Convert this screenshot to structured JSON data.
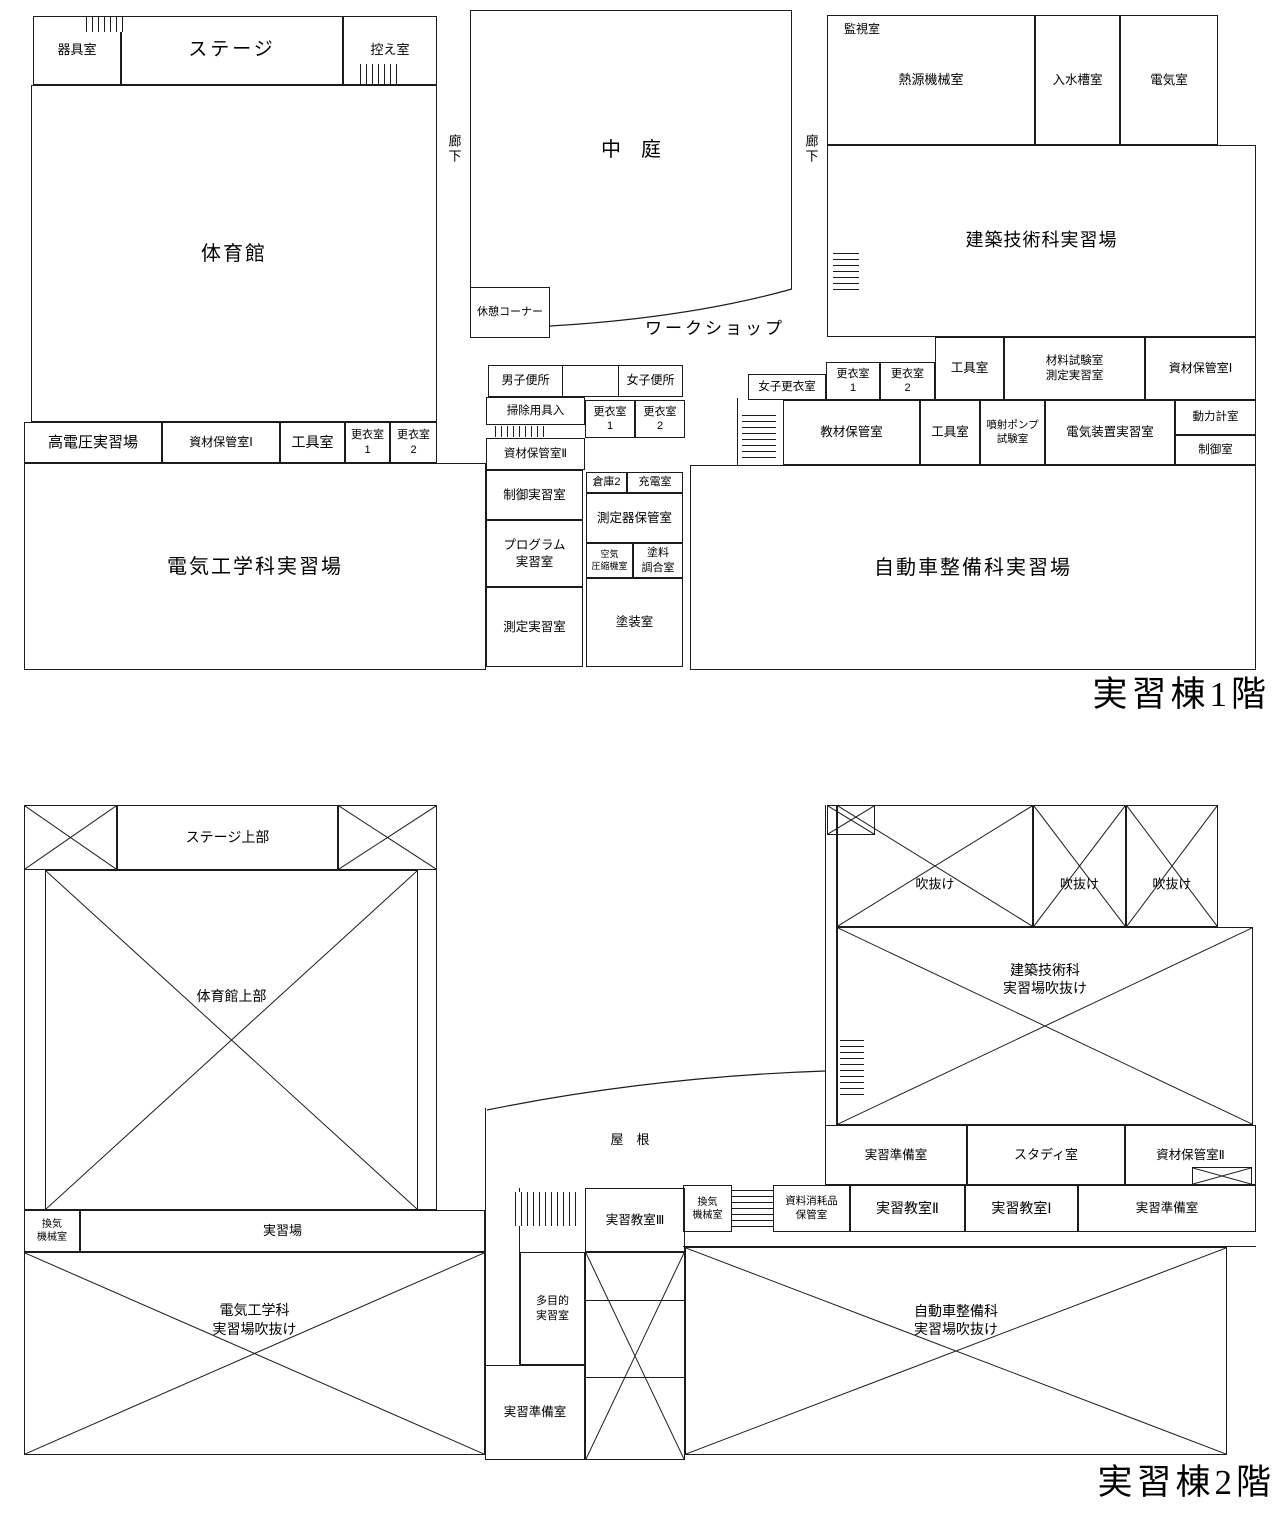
{
  "doc_title": "実習棟平面図",
  "floors": [
    {
      "name": "floor-1",
      "caption": "実習棟1階",
      "rooms": [
        {
          "id": "equipment-room",
          "label": "器具室",
          "x": 33,
          "y": 16,
          "w": 88,
          "h": 69,
          "fs": 13
        },
        {
          "id": "stage",
          "label": "ステージ",
          "x": 121,
          "y": 16,
          "w": 222,
          "h": 69,
          "fs": 19,
          "ls": 3
        },
        {
          "id": "green-room",
          "label": "控え室",
          "x": 343,
          "y": 16,
          "w": 94,
          "h": 69,
          "fs": 13
        },
        {
          "id": "stairs",
          "type": "stairs",
          "dir": "v",
          "x": 86,
          "y": 17,
          "w": 38,
          "h": 15
        },
        {
          "id": "stairs",
          "type": "stairs",
          "dir": "v",
          "x": 360,
          "y": 64,
          "w": 38,
          "h": 20
        },
        {
          "id": "gymnasium",
          "label": "体育館",
          "x": 31,
          "y": 85,
          "w": 406,
          "h": 337,
          "fs": 20,
          "ls": 2
        },
        {
          "id": "high-voltage-training-area",
          "label": "高電圧実習場",
          "x": 24,
          "y": 422,
          "w": 138,
          "h": 41,
          "fs": 15
        },
        {
          "id": "material-storage-room-1",
          "label": "資材保管室Ⅰ",
          "x": 162,
          "y": 422,
          "w": 118,
          "h": 41,
          "fs": 12
        },
        {
          "id": "tool-room",
          "label": "工具室",
          "x": 280,
          "y": 422,
          "w": 65,
          "h": 41,
          "fs": 14
        },
        {
          "id": "changing-room-1",
          "label": "更衣室\n1",
          "x": 345,
          "y": 422,
          "w": 45,
          "h": 41,
          "fs": 11
        },
        {
          "id": "changing-room-2",
          "label": "更衣室\n2",
          "x": 390,
          "y": 422,
          "w": 47,
          "h": 41,
          "fs": 11
        },
        {
          "id": "electrical-engineering-training-area",
          "label": "電気工学科実習場",
          "x": 24,
          "y": 463,
          "w": 462,
          "h": 207,
          "fs": 20,
          "ls": 2
        },
        {
          "id": "courtyard",
          "label": "中　庭",
          "x": 470,
          "y": 10,
          "w": 322,
          "h": 279,
          "fs": 20,
          "b": "ltr"
        },
        {
          "id": "corridor-label-left",
          "type": "label",
          "label": "廊下",
          "x": 442,
          "y": 126,
          "w": 22,
          "h": 46,
          "fs": 13,
          "vertical": true
        },
        {
          "id": "corridor-label-right",
          "type": "label",
          "label": "廊下",
          "x": 799,
          "y": 126,
          "w": 22,
          "h": 46,
          "fs": 13,
          "vertical": true
        },
        {
          "id": "rest-corner",
          "label": "休憩コーナー",
          "x": 470,
          "y": 287,
          "w": 80,
          "h": 51,
          "fs": 11
        },
        {
          "id": "workshop-label",
          "type": "label",
          "label": "ワークショップ",
          "x": 600,
          "y": 314,
          "w": 230,
          "h": 30,
          "fs": 17,
          "ls": 3
        },
        {
          "id": "mens-toilet",
          "label": "男子便所",
          "x": 488,
          "y": 365,
          "w": 75,
          "h": 32,
          "fs": 12
        },
        {
          "id": "toilet-lobby",
          "label": "",
          "x": 563,
          "y": 365,
          "w": 55,
          "h": 32,
          "b": "tb"
        },
        {
          "id": "womens-toilet",
          "label": "女子便所",
          "x": 618,
          "y": 365,
          "w": 65,
          "h": 32,
          "fs": 12
        },
        {
          "id": "cleaning-supplies-storage",
          "label": "掃除用具入",
          "x": 486,
          "y": 397,
          "w": 99,
          "h": 28,
          "fs": 11.5
        },
        {
          "id": "stairs",
          "type": "stairs",
          "dir": "v",
          "x": 495,
          "y": 426,
          "w": 50,
          "h": 11
        },
        {
          "id": "changing-room-1-center",
          "label": "更衣室\n1",
          "x": 585,
          "y": 400,
          "w": 50,
          "h": 38,
          "fs": 11
        },
        {
          "id": "changing-room-2-center",
          "label": "更衣室\n2",
          "x": 635,
          "y": 400,
          "w": 50,
          "h": 38,
          "fs": 11
        },
        {
          "id": "material-storage-room-2",
          "label": "資材保管室Ⅱ",
          "x": 486,
          "y": 438,
          "w": 99,
          "h": 32,
          "fs": 11.5
        },
        {
          "id": "control-training-room",
          "label": "制御実習室",
          "x": 486,
          "y": 470,
          "w": 97,
          "h": 50,
          "fs": 12.5
        },
        {
          "id": "warehouse-2",
          "label": "倉庫2",
          "x": 586,
          "y": 472,
          "w": 41,
          "h": 21,
          "fs": 11
        },
        {
          "id": "charging-room",
          "label": "充電室",
          "x": 627,
          "y": 472,
          "w": 56,
          "h": 21,
          "fs": 11
        },
        {
          "id": "instrument-storage-room",
          "label": "測定器保管室",
          "x": 586,
          "y": 493,
          "w": 97,
          "h": 50,
          "fs": 12.5
        },
        {
          "id": "program-training-room",
          "label": "プログラム\n実習室",
          "x": 486,
          "y": 520,
          "w": 97,
          "h": 67,
          "fs": 12.5
        },
        {
          "id": "air-compressor-room",
          "label": "空気\n圧縮機室",
          "x": 586,
          "y": 543,
          "w": 47,
          "h": 35,
          "fs": 9
        },
        {
          "id": "paint-mixing-room",
          "label": "塗料\n調合室",
          "x": 633,
          "y": 543,
          "w": 50,
          "h": 35,
          "fs": 11
        },
        {
          "id": "measurement-training-room",
          "label": "測定実習室",
          "x": 486,
          "y": 587,
          "w": 97,
          "h": 80,
          "fs": 12.5
        },
        {
          "id": "painting-room",
          "label": "塗装室",
          "x": 586,
          "y": 578,
          "w": 97,
          "h": 89,
          "fs": 12.5
        },
        {
          "id": "heat-source-machinery-room",
          "label": "熱源機械室",
          "x": 827,
          "y": 15,
          "w": 208,
          "h": 130,
          "fs": 13
        },
        {
          "id": "monitoring-room-label",
          "type": "label",
          "label": "監視室",
          "x": 833,
          "y": 20,
          "w": 58,
          "h": 20,
          "fs": 12
        },
        {
          "id": "water-tank-room",
          "label": "入水槽室",
          "x": 1035,
          "y": 15,
          "w": 85,
          "h": 130,
          "fs": 12.5
        },
        {
          "id": "electric-room",
          "label": "電気室",
          "x": 1120,
          "y": 15,
          "w": 98,
          "h": 130,
          "fs": 12.5
        },
        {
          "id": "architecture-training-area",
          "label": "建築技術科実習場",
          "x": 827,
          "y": 145,
          "w": 429,
          "h": 192,
          "fs": 18,
          "ls": 1
        },
        {
          "id": "stairs",
          "type": "stairs",
          "dir": "h",
          "x": 833,
          "y": 253,
          "w": 26,
          "h": 42
        },
        {
          "id": "womens-changing-room",
          "label": "女子更衣室",
          "x": 748,
          "y": 374,
          "w": 78,
          "h": 26,
          "fs": 11.5
        },
        {
          "id": "changing-room-1-right",
          "label": "更衣室\n1",
          "x": 826,
          "y": 362,
          "w": 54,
          "h": 38,
          "fs": 11
        },
        {
          "id": "changing-room-2-right",
          "label": "更衣室\n2",
          "x": 880,
          "y": 362,
          "w": 55,
          "h": 38,
          "fs": 11
        },
        {
          "id": "tool-room-right",
          "label": "工具室",
          "x": 935,
          "y": 337,
          "w": 69,
          "h": 63,
          "fs": 12.5
        },
        {
          "id": "material-test-room",
          "label": "材料試験室\n測定実習室",
          "x": 1004,
          "y": 337,
          "w": 141,
          "h": 63,
          "fs": 11.5
        },
        {
          "id": "material-storage-room-1-right",
          "label": "資材保管室Ⅰ",
          "x": 1145,
          "y": 337,
          "w": 111,
          "h": 63,
          "fs": 12
        },
        {
          "id": "wall",
          "type": "vline",
          "x": 737,
          "y": 398,
          "h": 67
        },
        {
          "id": "teaching-material-storage",
          "label": "教材保管室",
          "x": 783,
          "y": 400,
          "w": 137,
          "h": 65,
          "fs": 12.5
        },
        {
          "id": "tool-room-auto",
          "label": "工具室",
          "x": 920,
          "y": 400,
          "w": 60,
          "h": 65,
          "fs": 12.5
        },
        {
          "id": "injection-pump-test-room",
          "label": "噴射ポンプ\n試験室",
          "x": 980,
          "y": 400,
          "w": 65,
          "h": 65,
          "fs": 10.5
        },
        {
          "id": "electrical-equipment-training-room",
          "label": "電気装置実習室",
          "x": 1045,
          "y": 400,
          "w": 130,
          "h": 65,
          "fs": 12.5
        },
        {
          "id": "dynamometer-room",
          "label": "動力計室",
          "x": 1175,
          "y": 400,
          "w": 81,
          "h": 35,
          "fs": 11.5
        },
        {
          "id": "control-room",
          "label": "制御室",
          "x": 1175,
          "y": 435,
          "w": 81,
          "h": 30,
          "fs": 11.5
        },
        {
          "id": "stairs",
          "type": "stairs",
          "dir": "h",
          "x": 742,
          "y": 415,
          "w": 34,
          "h": 48
        },
        {
          "id": "auto-maintenance-training-area",
          "label": "自動車整備科実習場",
          "x": 690,
          "y": 465,
          "w": 566,
          "h": 205,
          "fs": 20,
          "ls": 2
        },
        {
          "id": "floor1-caption",
          "type": "label",
          "label": "実習棟1階",
          "x": 990,
          "y": 672,
          "w": 280,
          "h": 46,
          "fs": 35,
          "serif": true,
          "align": "right"
        }
      ]
    },
    {
      "name": "floor-2",
      "caption": "実習棟2階",
      "rooms": [
        {
          "id": "void-stage-left",
          "label": "",
          "x": 24,
          "y": 805,
          "w": 93,
          "h": 65,
          "cross": true
        },
        {
          "id": "stage-upper",
          "label": "ステージ上部",
          "x": 117,
          "y": 805,
          "w": 221,
          "h": 65,
          "fs": 14
        },
        {
          "id": "void-stage-right",
          "label": "",
          "x": 338,
          "y": 805,
          "w": 99,
          "h": 65,
          "cross": true
        },
        {
          "id": "gym-outer-wall",
          "label": "",
          "x": 24,
          "y": 870,
          "w": 413,
          "h": 340,
          "b": "lrb"
        },
        {
          "id": "gymnasium-upper",
          "label": "体育館上部",
          "x": 45,
          "y": 870,
          "w": 373,
          "h": 340,
          "cross": true,
          "fs": 14,
          "ly": 0.37
        },
        {
          "id": "ventilation-machinery-room-left",
          "label": "換気\n機械室",
          "x": 24,
          "y": 1210,
          "w": 56,
          "h": 42,
          "fs": 10
        },
        {
          "id": "training-area",
          "label": "実習場",
          "x": 80,
          "y": 1210,
          "w": 405,
          "h": 42,
          "fs": 13
        },
        {
          "id": "electrical-training-void",
          "label": "電気工学科\n実習場吹抜け",
          "x": 24,
          "y": 1252,
          "w": 461,
          "h": 203,
          "cross": true,
          "fs": 14,
          "ly": 0.33
        },
        {
          "id": "void-small-corner",
          "label": "",
          "x": 827,
          "y": 805,
          "w": 48,
          "h": 30,
          "cross": true
        },
        {
          "id": "void-1",
          "label": "吹抜け",
          "x": 837,
          "y": 805,
          "w": 196,
          "h": 122,
          "cross": true,
          "fs": 13,
          "ly": 0.66
        },
        {
          "id": "void-2",
          "label": "吹抜け",
          "x": 1033,
          "y": 805,
          "w": 93,
          "h": 122,
          "cross": true,
          "fs": 13,
          "ly": 0.66
        },
        {
          "id": "void-3",
          "label": "吹抜け",
          "x": 1126,
          "y": 805,
          "w": 92,
          "h": 122,
          "cross": true,
          "fs": 13,
          "ly": 0.66
        },
        {
          "id": "architecture-training-void",
          "label": "建築技術科\n実習場吹抜け",
          "x": 837,
          "y": 927,
          "w": 416,
          "h": 198,
          "cross": true,
          "fs": 14,
          "ly": 0.26
        },
        {
          "id": "corridor-wall",
          "label": "",
          "x": 825,
          "y": 805,
          "w": 12,
          "h": 320,
          "b": "lr"
        },
        {
          "id": "stairs",
          "type": "stairs",
          "dir": "h",
          "x": 840,
          "y": 1040,
          "w": 24,
          "h": 58
        },
        {
          "id": "training-prep-room-1",
          "label": "実習準備室",
          "x": 825,
          "y": 1125,
          "w": 142,
          "h": 60,
          "fs": 12.5
        },
        {
          "id": "study-room",
          "label": "スタディ室",
          "x": 967,
          "y": 1125,
          "w": 158,
          "h": 60,
          "fs": 13
        },
        {
          "id": "material-storage-room-2f",
          "label": "資材保管室Ⅱ",
          "x": 1125,
          "y": 1125,
          "w": 131,
          "h": 60,
          "fs": 12.5
        },
        {
          "id": "void-small-storage",
          "label": "",
          "x": 1192,
          "y": 1167,
          "w": 60,
          "h": 18,
          "cross": true
        },
        {
          "id": "ventilation-machinery-room-right",
          "label": "換気\n機械室",
          "x": 683,
          "y": 1185,
          "w": 49,
          "h": 47,
          "fs": 10
        },
        {
          "id": "stairs",
          "type": "stairs",
          "dir": "h",
          "x": 732,
          "y": 1190,
          "w": 41,
          "h": 42
        },
        {
          "id": "supplies-storage-room",
          "label": "資料消耗品\n保管室",
          "x": 773,
          "y": 1185,
          "w": 77,
          "h": 47,
          "fs": 10.5
        },
        {
          "id": "training-classroom-2",
          "label": "実習教室Ⅱ",
          "x": 850,
          "y": 1185,
          "w": 115,
          "h": 47,
          "fs": 14
        },
        {
          "id": "training-classroom-1",
          "label": "実習教室Ⅰ",
          "x": 965,
          "y": 1185,
          "w": 113,
          "h": 47,
          "fs": 14
        },
        {
          "id": "training-prep-room-2",
          "label": "実習準備室",
          "x": 1078,
          "y": 1185,
          "w": 178,
          "h": 47,
          "fs": 12.5
        },
        {
          "id": "corridor-strip",
          "label": "",
          "x": 683,
          "y": 1232,
          "w": 573,
          "h": 15,
          "b": "b"
        },
        {
          "id": "training-classroom-3",
          "label": "実習教室Ⅲ",
          "x": 585,
          "y": 1188,
          "w": 100,
          "h": 64,
          "fs": 12.5
        },
        {
          "id": "stairs",
          "type": "stairs",
          "dir": "v",
          "x": 515,
          "y": 1192,
          "w": 62,
          "h": 34
        },
        {
          "id": "corridor-center",
          "label": "",
          "x": 485,
          "y": 1188,
          "w": 35,
          "h": 177,
          "b": "lr"
        },
        {
          "id": "wall-roof-left",
          "type": "vline",
          "x": 485,
          "y": 1108,
          "h": 80
        },
        {
          "id": "multipurpose-training-room",
          "label": "多目的\n実習室",
          "x": 520,
          "y": 1252,
          "w": 65,
          "h": 113,
          "fs": 11
        },
        {
          "id": "training-prep-room-3",
          "label": "実習準備室",
          "x": 485,
          "y": 1365,
          "w": 100,
          "h": 95,
          "fs": 12.5
        },
        {
          "id": "void-center-strip",
          "label": "",
          "x": 585,
          "y": 1252,
          "w": 100,
          "h": 208,
          "cross": true
        },
        {
          "id": "wall",
          "type": "hline",
          "x": 585,
          "y": 1300,
          "w": 100
        },
        {
          "id": "wall",
          "type": "hline",
          "x": 585,
          "y": 1377,
          "w": 100
        },
        {
          "id": "roof-label",
          "type": "label",
          "label": "屋　根",
          "x": 560,
          "y": 1125,
          "w": 140,
          "h": 30,
          "fs": 13
        },
        {
          "id": "auto-maintenance-void",
          "label": "自動車整備科\n実習場吹抜け",
          "x": 685,
          "y": 1247,
          "w": 542,
          "h": 208,
          "cross": true,
          "fs": 14,
          "ly": 0.35
        },
        {
          "id": "floor2-caption",
          "type": "label",
          "label": "実習棟2階",
          "x": 990,
          "y": 1460,
          "w": 285,
          "h": 46,
          "fs": 35,
          "serif": true,
          "align": "right"
        }
      ]
    }
  ]
}
